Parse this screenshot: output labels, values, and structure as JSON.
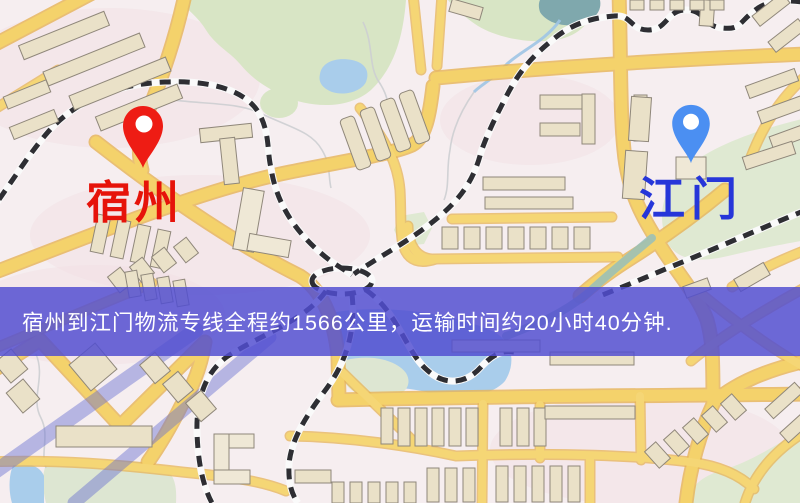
{
  "map_view": {
    "origin": {
      "name": "宿州",
      "pin_color": "#ee1c14",
      "label_color": "#e6130a"
    },
    "destination": {
      "name": "江门",
      "pin_color": "#4b8ff2",
      "label_color": "#2636d9"
    },
    "banner": {
      "text": "宿州到江门物流专线全程约1566公里，运输时间约20小时40分钟.",
      "background_color": "#514ed1",
      "text_color": "#ffffff",
      "distance_text": "1566公里",
      "duration_text": "20小时40分钟"
    },
    "palette": {
      "background": "#f6eef0",
      "road_fill": "#f4d26b",
      "road_casing": "#e7b457",
      "building_fill": "#eae1c8",
      "building_outline": "#8f877a",
      "park_green": "#d8e5c5",
      "water_blue": "#a9cdeb",
      "water_teal": "#7fa8ad",
      "railway_dark": "#2e2e33",
      "blue_road": "#686ed0"
    }
  }
}
